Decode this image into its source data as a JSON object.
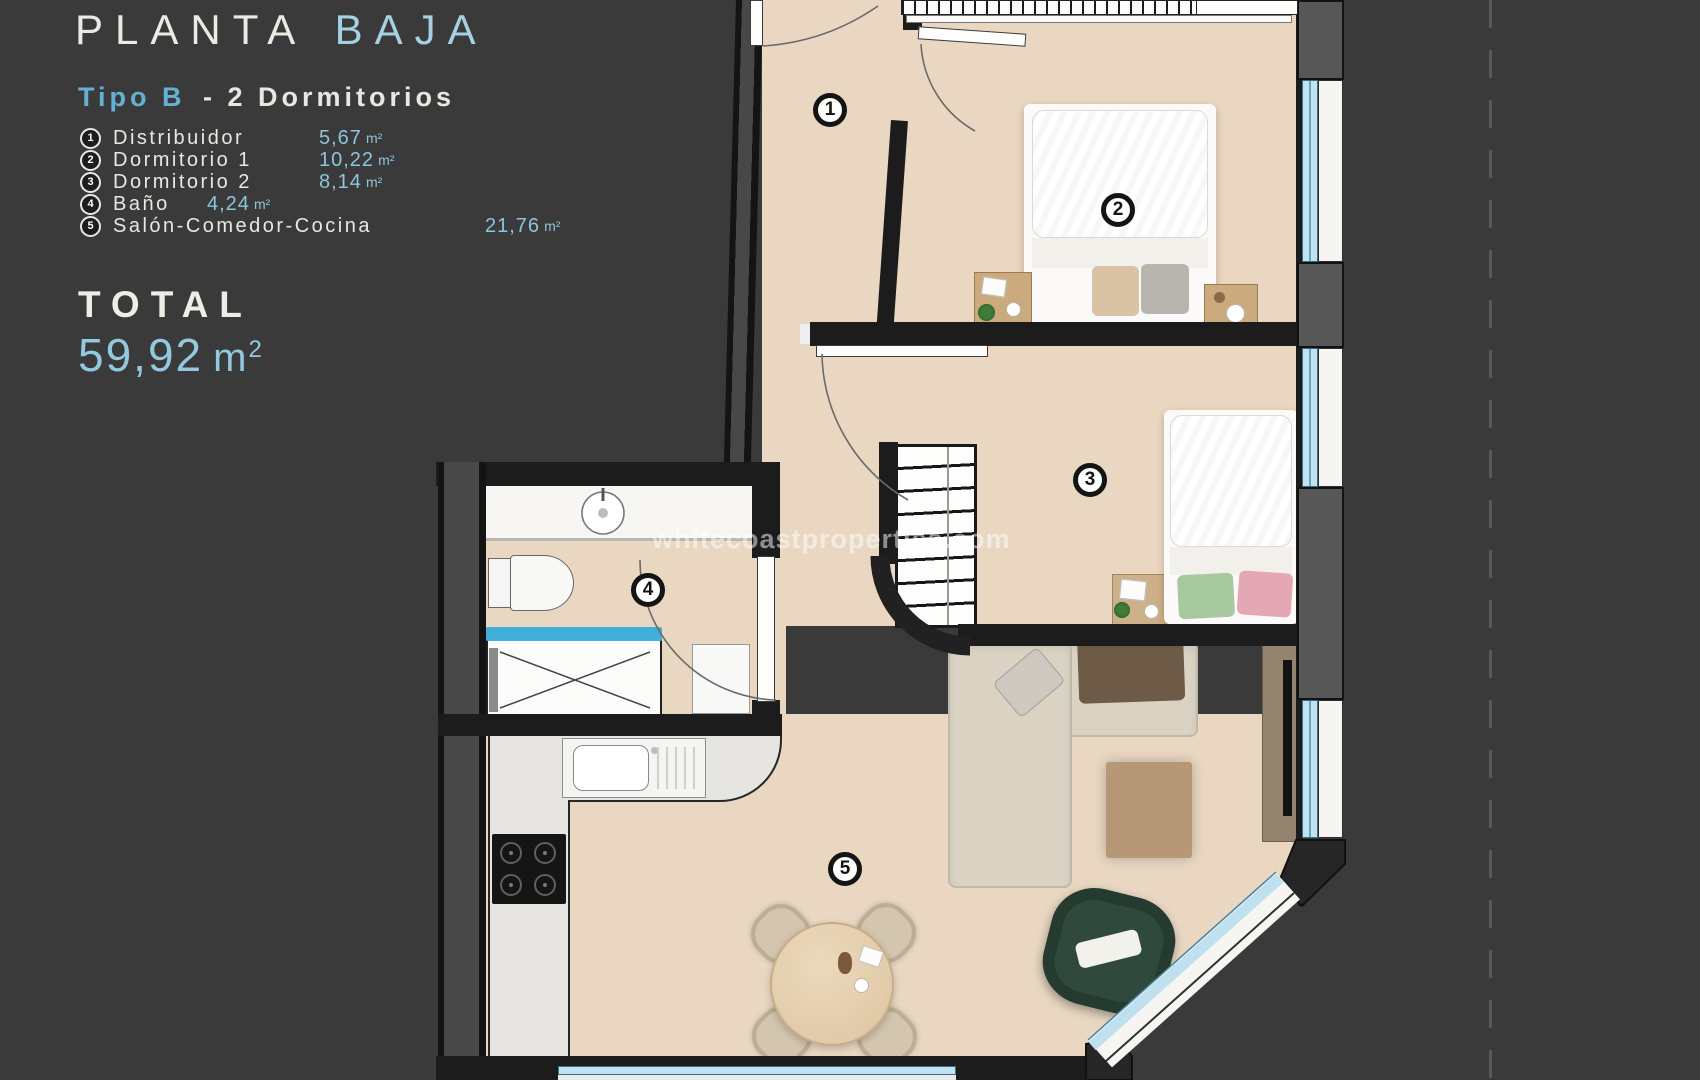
{
  "header": {
    "title_main": "PLANTA",
    "title_accent": "BAJA",
    "subtitle_accent": "Tipo B",
    "subtitle_rest": "- 2  Dormitorios"
  },
  "legend": {
    "items": [
      {
        "num": "1",
        "name": "Distribuidor",
        "value": "5,67",
        "unit": "m²"
      },
      {
        "num": "2",
        "name": "Dormitorio 1",
        "value": "10,22",
        "unit": "m²"
      },
      {
        "num": "3",
        "name": "Dormitorio 2",
        "value": "8,14",
        "unit": "m²"
      },
      {
        "num": "4",
        "name": "Baño",
        "value": "4,24",
        "unit": "m²"
      },
      {
        "num": "5",
        "name": "Salón-Comedor-Cocina",
        "value": "21,76",
        "unit": "m²"
      }
    ]
  },
  "total": {
    "label": "TOTAL",
    "value": "59,92",
    "unit_base": "m",
    "unit_sup": "2"
  },
  "watermark": {
    "text": "whitecoastproperties.com"
  },
  "plan": {
    "labels": [
      {
        "num": "1"
      },
      {
        "num": "2"
      },
      {
        "num": "3"
      },
      {
        "num": "4"
      },
      {
        "num": "5"
      }
    ]
  },
  "colors": {
    "background": "#3a3a3a",
    "floor": "#e9d7c1",
    "wall": "#1c1c1c",
    "accent_blue": "#8cc5dc",
    "glazing": "#c3e2f0",
    "shower_glass": "#41afd7"
  }
}
